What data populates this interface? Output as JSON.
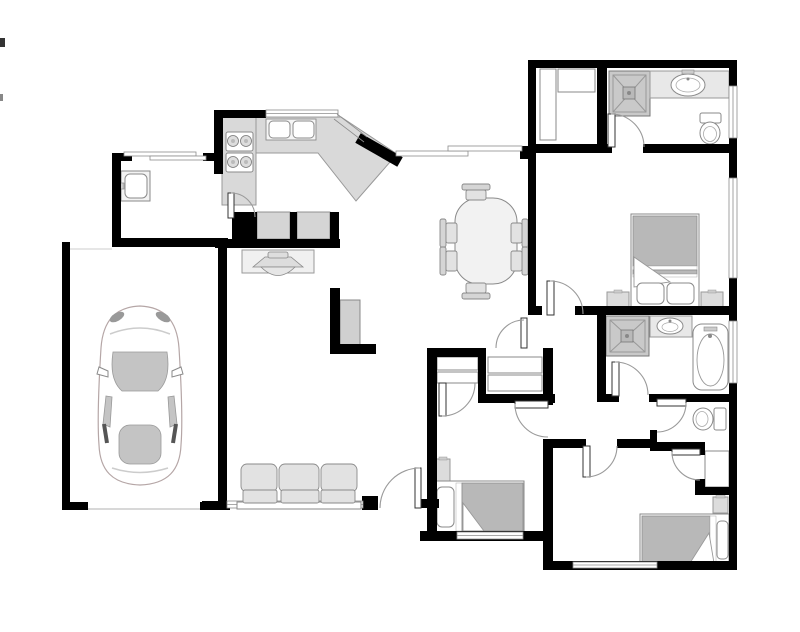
{
  "figure": {
    "kind": "residential-floor-plan",
    "description": "single-story house floor plan, top-down architectural view, no text labels",
    "style": "black walls, gray furniture fills, white floor"
  },
  "canvas": {
    "width": 800,
    "height": 632,
    "background": "#ffffff"
  },
  "palette": {
    "wall": "#000000",
    "window_line": "#8c8c8c",
    "door_arc": "#9a9a9a",
    "counter": "#d9d9d9",
    "cabinet": "#d5d5d5",
    "shower": "#c9c9c9",
    "fixture_outline": "#8a8a8a",
    "blanket": "#b8b8b8",
    "sofa": "#e2e2e2",
    "car_glass": "#c4c4c4",
    "car_outline": "#b5a6a6"
  },
  "rooms": [
    {
      "name": "garage",
      "items": [
        "car-top-view",
        "garage-door-opening"
      ]
    },
    {
      "name": "laundry-room",
      "items": [
        "utility-sink",
        "window"
      ]
    },
    {
      "name": "kitchen",
      "items": [
        "l-shaped-counter",
        "range-cooktop-4-burners",
        "double-basin-sink",
        "window-over-sink",
        "diagonal-counter",
        "sliding-patio-door"
      ]
    },
    {
      "name": "dining-area",
      "items": [
        "oval-table",
        "chair-x6"
      ]
    },
    {
      "name": "family-room",
      "items": [
        "sofa-3-seat",
        "tv-console",
        "built-in-cabinets-x2",
        "bookshelf",
        "front-door",
        "window-behind-sofa"
      ]
    },
    {
      "name": "hallway",
      "items": [
        "linen-closet-with-shelves"
      ]
    },
    {
      "name": "master-bathroom",
      "items": [
        "walk-in-closet-shelves",
        "shower-stall",
        "vanity-with-oval-sink",
        "toilet",
        "window"
      ]
    },
    {
      "name": "master-bedroom",
      "items": [
        "double-bed-with-pillows",
        "nightstand-x2",
        "window"
      ]
    },
    {
      "name": "bathroom-2",
      "items": [
        "shower-stall",
        "vanity-with-oval-sink",
        "bathtub",
        "window"
      ]
    },
    {
      "name": "half-bathroom",
      "items": [
        "toilet"
      ]
    },
    {
      "name": "bedroom-2",
      "items": [
        "single-bed-with-pillow",
        "nightstand",
        "closet-with-shelves",
        "window"
      ]
    },
    {
      "name": "bedroom-3",
      "items": [
        "single-bed-with-pillow",
        "nightstand",
        "closet",
        "window"
      ]
    }
  ],
  "summary": {
    "bedrooms": 3,
    "bathrooms": 3,
    "door_swings": 11,
    "windows": 10,
    "garage_cars": 1
  }
}
